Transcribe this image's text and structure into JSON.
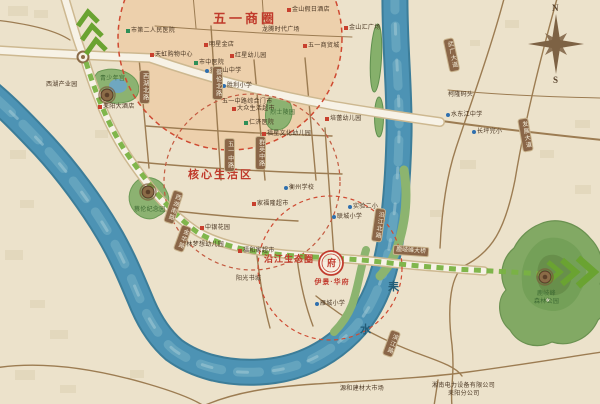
{
  "map": {
    "zones": [
      {
        "label": "五一商圈"
      },
      {
        "label": "核心生活区"
      },
      {
        "label": "沿江生态圈"
      }
    ],
    "project": {
      "name": "伊景·华府",
      "seal_char": "府"
    },
    "river": {
      "char1": "耒",
      "char2": "水"
    },
    "compass": {
      "north": "N",
      "south": "S"
    },
    "bridge": {
      "label": "鹿岐峰大桥"
    },
    "colors": {
      "accent_red": "#c03a2b",
      "route_green": "#79b243",
      "river_blue": "#4d93b4",
      "road_brown": "#9c7c52"
    },
    "pois": [
      {
        "t": "金山假日酒店",
        "x": 287,
        "y": 7,
        "m": "r"
      },
      {
        "t": "龙腾时代广场",
        "x": 262,
        "y": 27,
        "m": "n"
      },
      {
        "t": "金山汇广场",
        "x": 344,
        "y": 25,
        "m": "r"
      },
      {
        "t": "五一商贸城",
        "x": 303,
        "y": 43,
        "m": "r"
      },
      {
        "t": "天虹购物中心",
        "x": 150,
        "y": 52,
        "m": "r"
      },
      {
        "t": "市中医院",
        "x": 194,
        "y": 60,
        "m": "g"
      },
      {
        "t": "明星金店",
        "x": 204,
        "y": 42,
        "m": "r"
      },
      {
        "t": "红星幼儿园",
        "x": 230,
        "y": 53,
        "m": "r"
      },
      {
        "t": "狮子山中学",
        "x": 205,
        "y": 68,
        "m": "b"
      },
      {
        "t": "胜利小学",
        "x": 222,
        "y": 83,
        "m": "b"
      },
      {
        "t": "五一中路综合门市",
        "x": 222,
        "y": 99,
        "m": "n"
      },
      {
        "t": "市第二人民医院",
        "x": 126,
        "y": 28,
        "m": "g"
      },
      {
        "t": "西湖产业园",
        "x": 46,
        "y": 82,
        "m": "n"
      },
      {
        "t": "青少年宫",
        "x": 100,
        "y": 76,
        "m": "n",
        "c": "gr"
      },
      {
        "t": "耒阳大酒店",
        "x": 98,
        "y": 104,
        "m": "r"
      },
      {
        "t": "大众生活超市",
        "x": 232,
        "y": 106,
        "m": "r"
      },
      {
        "t": "仁济医院",
        "x": 244,
        "y": 120,
        "m": "g"
      },
      {
        "t": "烈士陵园",
        "x": 270,
        "y": 110,
        "m": "n",
        "c": "gr"
      },
      {
        "t": "培蕾幼儿园",
        "x": 325,
        "y": 116,
        "m": "r"
      },
      {
        "t": "福星文化幼儿园",
        "x": 262,
        "y": 131,
        "m": "r"
      },
      {
        "t": "衡州学校",
        "x": 284,
        "y": 185,
        "m": "b"
      },
      {
        "t": "家福隆超市",
        "x": 252,
        "y": 201,
        "m": "r"
      },
      {
        "t": "实验二小",
        "x": 348,
        "y": 204,
        "m": "b"
      },
      {
        "t": "联城小学",
        "x": 332,
        "y": 214,
        "m": "b"
      },
      {
        "t": "中银花园",
        "x": 200,
        "y": 225,
        "m": "r"
      },
      {
        "t": "翰林梦想幼儿园",
        "x": 175,
        "y": 242,
        "m": "b"
      },
      {
        "t": "福和家超市",
        "x": 238,
        "y": 248,
        "m": "r"
      },
      {
        "t": "阳光书城",
        "x": 236,
        "y": 276,
        "m": "n"
      },
      {
        "t": "雁城小学",
        "x": 315,
        "y": 301,
        "m": "b"
      },
      {
        "t": "蔡伦纪念园",
        "x": 134,
        "y": 207,
        "m": "n",
        "c": "gr"
      },
      {
        "t": "鹿岐峰",
        "x": 537,
        "y": 291,
        "m": "n",
        "c": "gr"
      },
      {
        "t": "森林公园",
        "x": 534,
        "y": 299,
        "m": "n",
        "c": "gr"
      },
      {
        "t": "柯隆码头",
        "x": 448,
        "y": 92,
        "m": "n"
      },
      {
        "t": "水东江中学",
        "x": 446,
        "y": 112,
        "m": "b"
      },
      {
        "t": "长坪完小",
        "x": 472,
        "y": 129,
        "m": "b"
      },
      {
        "t": "源和建材大市场",
        "x": 340,
        "y": 386,
        "m": "n"
      },
      {
        "t": "湘南电力设备有限公司",
        "x": 432,
        "y": 383,
        "m": "n"
      },
      {
        "t": "耒阳分公司",
        "x": 448,
        "y": 391,
        "m": "n"
      }
    ],
    "road_plaques": [
      {
        "t": "西湖北路",
        "x": 139,
        "y": 70
      },
      {
        "t": "蔡伦北路",
        "x": 212,
        "y": 66
      },
      {
        "t": "五一中路",
        "x": 224,
        "y": 138
      },
      {
        "t": "群英中路",
        "x": 255,
        "y": 136
      },
      {
        "t": "西湖南路",
        "x": 168,
        "y": 190,
        "r": 18
      },
      {
        "t": "金华路",
        "x": 177,
        "y": 225,
        "r": 20
      },
      {
        "t": "武广大道",
        "x": 446,
        "y": 38,
        "r": -12
      },
      {
        "t": "发展大道",
        "x": 520,
        "y": 118,
        "r": -10
      },
      {
        "t": "沿江北路",
        "x": 373,
        "y": 208,
        "r": 8
      },
      {
        "t": "滨江路",
        "x": 386,
        "y": 330,
        "r": 20
      }
    ]
  }
}
